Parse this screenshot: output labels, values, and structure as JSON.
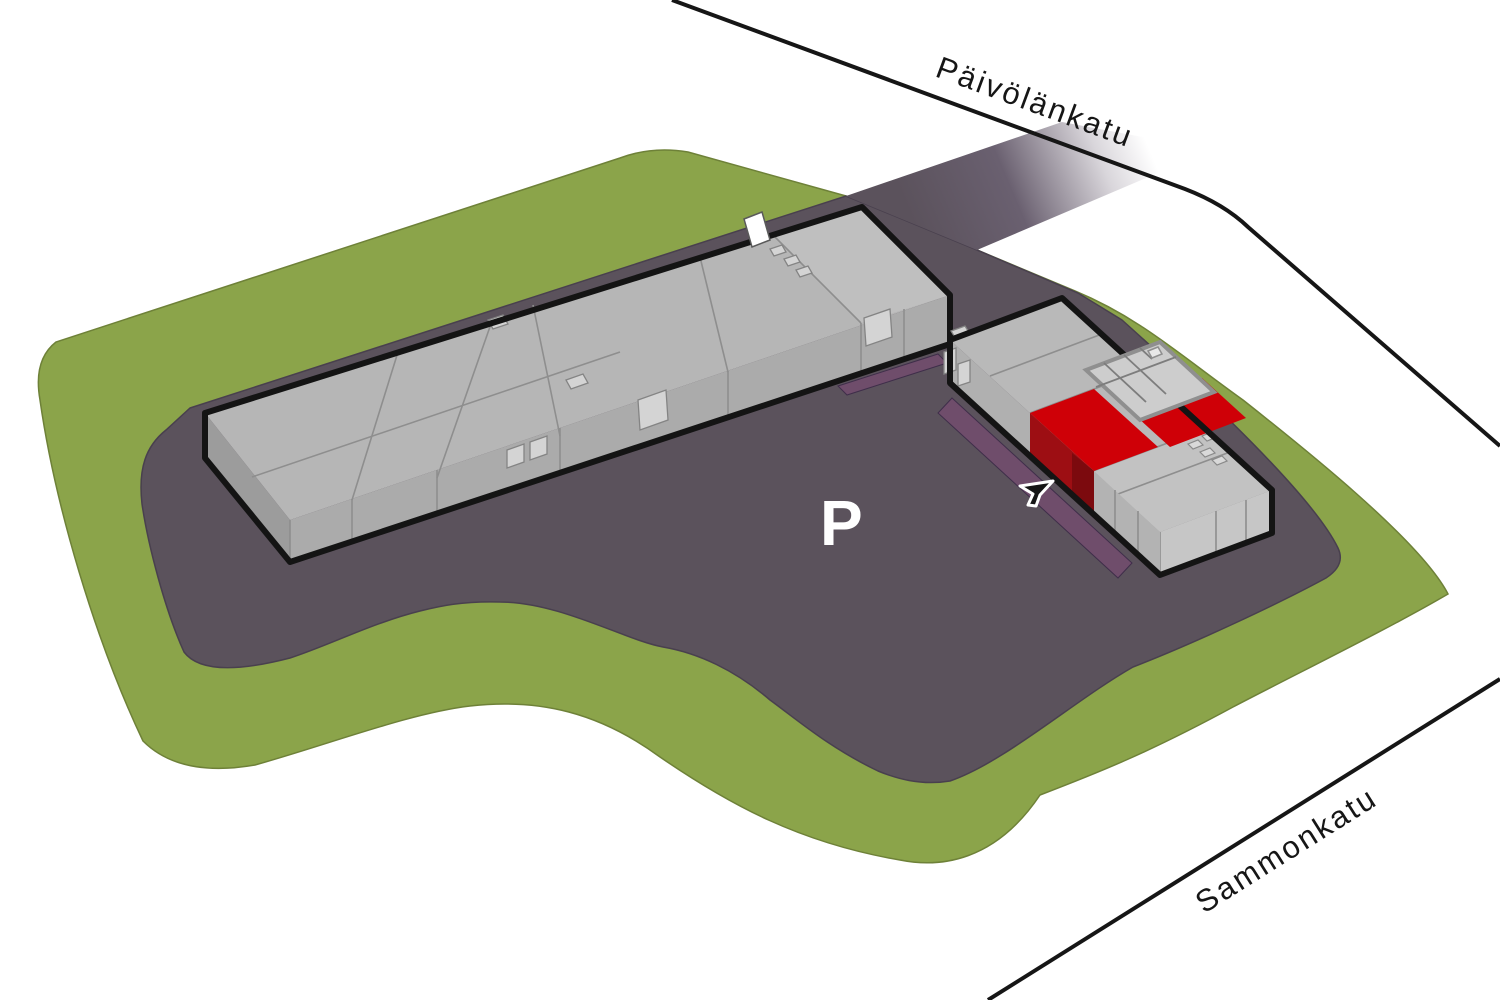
{
  "site_plan": {
    "streets": {
      "top_label": "Päivölänkatu",
      "bottom_label": "Sammonkatu"
    },
    "parking_area_label": "P",
    "colors": {
      "grass": "#8ba44a",
      "asphalt": "#5b525c",
      "roof_gray": "#b6b6b6",
      "highlight_red": "#cf0007",
      "highlight_red_dark": "#9d0e13",
      "outline_black": "#141414",
      "parking_strip_purple": "#6f4d6b"
    }
  }
}
